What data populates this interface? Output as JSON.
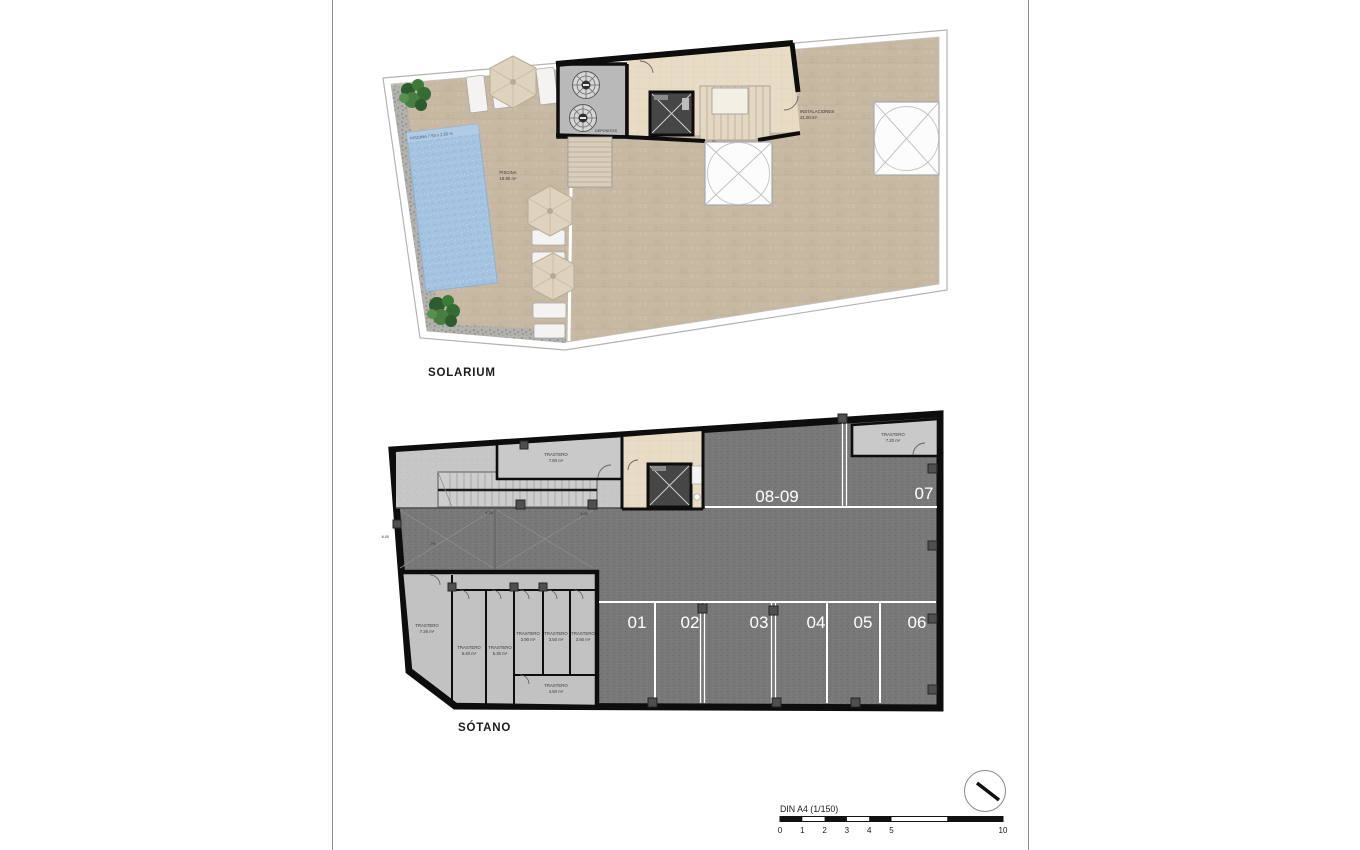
{
  "solarium": {
    "title": "SOLARIUM",
    "pool": {
      "dim_label": "PISCINA 7.50 x 2.50 m",
      "name": "PISCINA",
      "area": "18.80 m²"
    },
    "depositos": {
      "label": "DEPOSITOS"
    },
    "instalaciones": {
      "name": "INSTALACIONES",
      "area": "41.00 m²"
    }
  },
  "sotano": {
    "title": "SÓTANO",
    "parking_spaces": [
      "01",
      "02",
      "03",
      "04",
      "05",
      "06"
    ],
    "parking_top": [
      "08-09",
      "07"
    ],
    "trasteros": [
      {
        "name": "TRASTERO",
        "area": "7.60 m²"
      },
      {
        "name": "TRASTERO",
        "area": "7.20 m²"
      },
      {
        "name": "TRASTERO",
        "area": "7.26 m²"
      },
      {
        "name": "TRASTERO",
        "area": "5.40 m²"
      },
      {
        "name": "TRASTERO",
        "area": "5.30 m²"
      },
      {
        "name": "TRASTERO",
        "area": "3.90 m²"
      },
      {
        "name": "TRASTERO",
        "area": "3.50 m²"
      },
      {
        "name": "TRASTERO",
        "area": "3.90 m²"
      },
      {
        "name": "TRASTERO",
        "area": "4.50 m²"
      }
    ],
    "ramp": {
      "dim_a": "4.25",
      "dim_b": "4.00",
      "dim_c": "6.00",
      "slope": "7%"
    }
  },
  "scalebar": {
    "label": "DIN A4 (1/150)",
    "ticks": [
      "0",
      "1",
      "2",
      "3",
      "4",
      "5",
      "10"
    ]
  },
  "colors": {
    "terrace_beige": "#c7b9a3",
    "core_beige": "#e8dcc6",
    "pool_blue": "#a4c3e0",
    "asphalt_gray": "#787878",
    "storage_gray": "#c9c9c9",
    "wall_black": "#0d0d0d",
    "parking_line_white": "#ffffff"
  }
}
